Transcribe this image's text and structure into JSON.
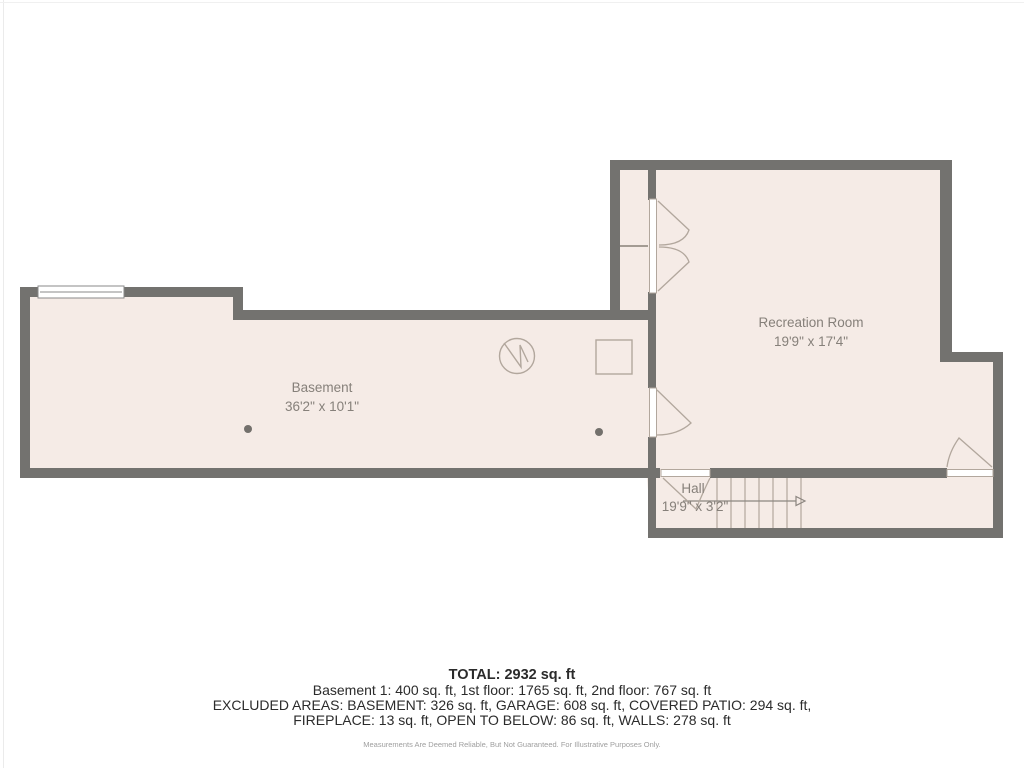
{
  "floor_plan": {
    "rooms": [
      {
        "name": "Basement",
        "dimensions": "36'2\" x 10'1\""
      },
      {
        "name": "Recreation Room",
        "dimensions": "19'9\" x 17'4\""
      },
      {
        "name": "Hall",
        "dimensions": "19'9\" x 3'2\""
      }
    ],
    "symbols": [
      "water-heater-circle-icon",
      "utility-square-icon",
      "support-column-dot",
      "support-column-dot",
      "window-symbol",
      "door-swing-arcs",
      "staircase-with-direction-arrow"
    ]
  },
  "summary": {
    "total": "TOTAL: 2932 sq. ft",
    "floor_breakdown": "Basement 1: 400 sq. ft, 1st floor: 1765 sq. ft, 2nd floor: 767 sq. ft",
    "excluded_line1": "EXCLUDED AREAS: BASEMENT: 326 sq. ft, GARAGE: 608 sq. ft, COVERED PATIO: 294 sq. ft,",
    "excluded_line2": "FIREPLACE: 13 sq. ft, OPEN TO BELOW: 86 sq. ft, WALLS: 278 sq. ft",
    "disclaimer": "Measurements Are Deemed Reliable, But Not Guaranteed. For Illustrative Purposes Only."
  },
  "colors": {
    "wall": "#73726f",
    "floor": "#f5ebe6",
    "symbol_stroke": "#b2a79d",
    "room_label": "#86807a",
    "summary_text": "#2b2b2b",
    "disclaimer_text": "#9e9e9e"
  }
}
